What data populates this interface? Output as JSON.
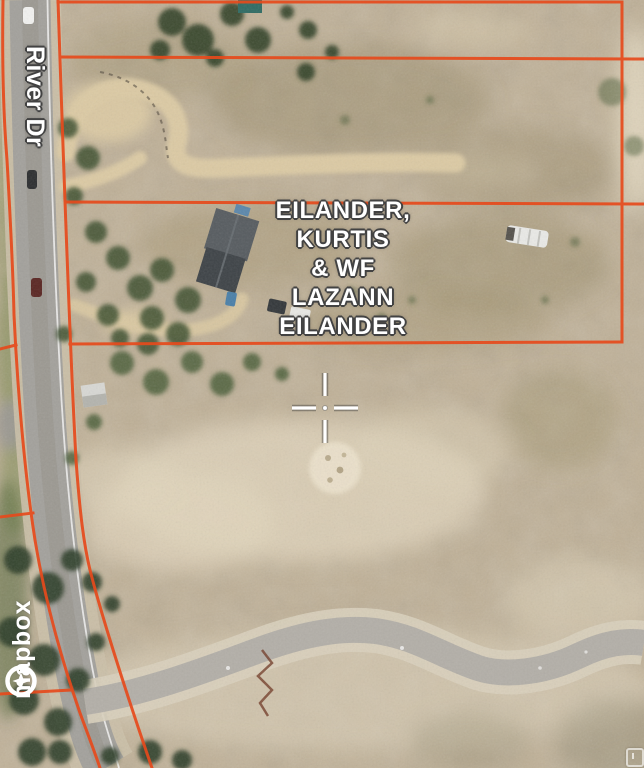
{
  "map": {
    "road_label": "River Dr",
    "parcel_label": "EILANDER,\nKURTIS\n& WF\nLAZANN\nEILANDER",
    "attribution": {
      "provider": "mapbox"
    },
    "marker": {
      "type": "crosshair"
    },
    "colors": {
      "parcel_boundary": "#e64a1c",
      "label_text": "#ffffff",
      "label_halo": "#424242",
      "terrain_base": "#c0b197",
      "road_asphalt": "#a3a19c"
    }
  }
}
